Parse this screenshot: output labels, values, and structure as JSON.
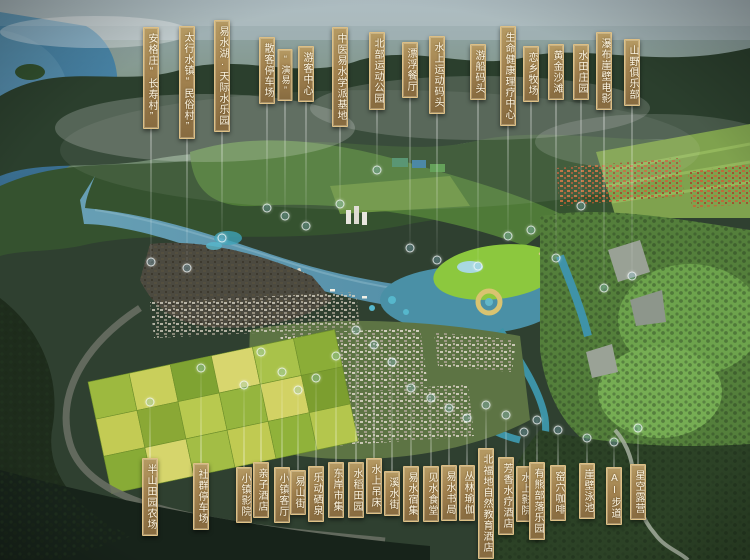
{
  "colors": {
    "plaque_gold": "#a2824f",
    "plaque_border": "#e2c489",
    "plaque_text": "#fcf5e2",
    "leader_line": "#ffffff",
    "river": "#5f97ae",
    "lawn": "#8cc83e",
    "farm_yellow": "#c9cf5b",
    "forest_dark": "#1e2c1c"
  },
  "top_labels": [
    {
      "id": "angezhuang-changshou-village",
      "text": "安格庄“长寿村”",
      "x": 151,
      "y": 27,
      "line_to": 262
    },
    {
      "id": "taihang-water-town-folk-village",
      "text": "太行水镇“民俗村”",
      "x": 187,
      "y": 26,
      "line_to": 268
    },
    {
      "id": "yishui-lake-tianji-waterpark",
      "text": "易水湖·天际水乐园",
      "x": 222,
      "y": 20,
      "line_to": 238
    },
    {
      "id": "visitor-parking-lot",
      "text": "散客停车场",
      "x": 267,
      "y": 37,
      "line_to": 208
    },
    {
      "id": "yanyi-show",
      "text": "“演易”",
      "x": 285,
      "y": 49,
      "line_to": 216,
      "small": true
    },
    {
      "id": "visitor-center",
      "text": "游客中心",
      "x": 306,
      "y": 46,
      "line_to": 226
    },
    {
      "id": "tcm-yishui-school-base",
      "text": "中医易水学派基地",
      "x": 340,
      "y": 27,
      "line_to": 204
    },
    {
      "id": "north-sports-park",
      "text": "北部运动公园",
      "x": 377,
      "y": 32,
      "line_to": 170
    },
    {
      "id": "floating-restaurant",
      "text": "漂浮餐厅",
      "x": 410,
      "y": 42,
      "line_to": 248
    },
    {
      "id": "water-sports-pier",
      "text": "水上运动码头",
      "x": 437,
      "y": 36,
      "line_to": 260
    },
    {
      "id": "cruise-boat-pier",
      "text": "游船码头",
      "x": 478,
      "y": 44,
      "line_to": 266
    },
    {
      "id": "life-health-therapy-center",
      "text": "生命健康理疗中心",
      "x": 508,
      "y": 26,
      "line_to": 236
    },
    {
      "id": "lianxiang-ranch",
      "text": "恋乡牧场",
      "x": 531,
      "y": 46,
      "line_to": 230
    },
    {
      "id": "golden-beach",
      "text": "黄金沙滩",
      "x": 556,
      "y": 44,
      "line_to": 258
    },
    {
      "id": "paddy-field-manor",
      "text": "水田庄园",
      "x": 581,
      "y": 44,
      "line_to": 206
    },
    {
      "id": "waterfall-cliff-cinema",
      "text": "瀑布崖壁电影",
      "x": 604,
      "y": 32,
      "line_to": 288
    },
    {
      "id": "mountain-wilderness-club",
      "text": "山野俱乐部",
      "x": 632,
      "y": 39,
      "line_to": 276
    }
  ],
  "bottom_labels": [
    {
      "id": "hillside-pastoral-farm",
      "text": "半山田园农场",
      "x": 150,
      "y": 458,
      "line_to": 402
    },
    {
      "id": "community-parking-lot",
      "text": "社群停车场",
      "x": 201,
      "y": 463,
      "line_to": 368
    },
    {
      "id": "town-cinema",
      "text": "小镇影院",
      "x": 244,
      "y": 467,
      "line_to": 385
    },
    {
      "id": "family-hotel",
      "text": "亲子酒店",
      "x": 261,
      "y": 462,
      "line_to": 352
    },
    {
      "id": "town-living-room",
      "text": "小镇客厅",
      "x": 282,
      "y": 467,
      "line_to": 372
    },
    {
      "id": "yishan-street",
      "text": "易山街",
      "x": 298,
      "y": 470,
      "line_to": 390
    },
    {
      "id": "ledong-mineral-spring",
      "text": "乐动硒泉",
      "x": 316,
      "y": 466,
      "line_to": 378
    },
    {
      "id": "east-bank-market",
      "text": "东岸市集",
      "x": 336,
      "y": 462,
      "line_to": 356
    },
    {
      "id": "rice-paddy-fields",
      "text": "水稻田园",
      "x": 356,
      "y": 462,
      "line_to": 330
    },
    {
      "id": "water-hammock",
      "text": "水上吊床",
      "x": 374,
      "y": 458,
      "line_to": 345
    },
    {
      "id": "stream-street",
      "text": "溪水街",
      "x": 392,
      "y": 471,
      "line_to": 362
    },
    {
      "id": "yishui-lodging-cluster",
      "text": "易水宿集",
      "x": 411,
      "y": 466,
      "line_to": 388
    },
    {
      "id": "jianshui-canteen",
      "text": "见水食堂",
      "x": 431,
      "y": 466,
      "line_to": 398
    },
    {
      "id": "yishui-bookstore",
      "text": "易水书局",
      "x": 449,
      "y": 465,
      "line_to": 408
    },
    {
      "id": "jungle-yoga",
      "text": "丛林瑜伽",
      "x": 467,
      "y": 465,
      "line_to": 418
    },
    {
      "id": "beifudi-nature-education-hotel",
      "text": "北福地自然教育酒店",
      "x": 486,
      "y": 448,
      "line_to": 405
    },
    {
      "id": "aroma-spa-hotel",
      "text": "芳香水疗酒店",
      "x": 506,
      "y": 457,
      "line_to": 415
    },
    {
      "id": "water-cinema",
      "text": "水上影院",
      "x": 524,
      "y": 466,
      "line_to": 432
    },
    {
      "id": "youxiong-tribe-park",
      "text": "有熊部落乐园",
      "x": 537,
      "y": 462,
      "line_to": 420
    },
    {
      "id": "kiln-cave-cafe",
      "text": "窑穴咖啡",
      "x": 558,
      "y": 465,
      "line_to": 430
    },
    {
      "id": "cliff-swimming-pool",
      "text": "崖壁泳池",
      "x": 587,
      "y": 463,
      "line_to": 438
    },
    {
      "id": "ai-trail",
      "text": "AI步道",
      "x": 614,
      "y": 467,
      "line_to": 442
    },
    {
      "id": "stargazing-camp",
      "text": "星空露营",
      "x": 638,
      "y": 464,
      "line_to": 428
    }
  ]
}
